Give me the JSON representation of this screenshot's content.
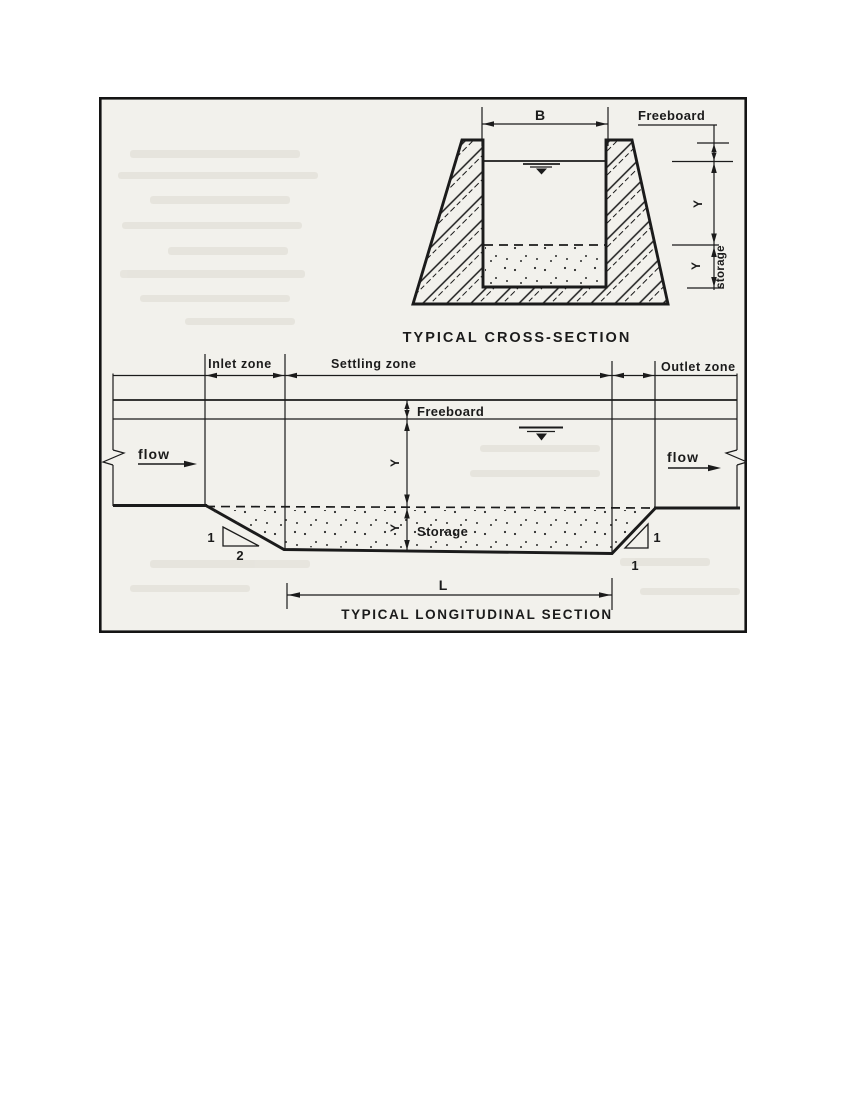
{
  "page": {
    "background": "#ffffff"
  },
  "figure": {
    "paper_color": "#f2f1ec",
    "ink_color": "#1b1b1b",
    "cross_section": {
      "title": "TYPICAL CROSS-SECTION",
      "width_dim": "B",
      "freeboard_label": "Freeboard",
      "depth_label": "Y",
      "storage_depth_label": "Y",
      "storage_label": "storage"
    },
    "longitudinal_section": {
      "title": "TYPICAL LONGITUDINAL SECTION",
      "inlet_zone_label": "Inlet zone",
      "settling_zone_label": "Settling zone",
      "outlet_zone_label": "Outlet zone",
      "freeboard_label": "Freeboard",
      "storage_label": "Storage",
      "flow_left_label": "flow",
      "flow_right_label": "flow",
      "depth_label": "Y",
      "storage_depth_label": "Y",
      "length_dim": "L",
      "inlet_slope_vertical": "1",
      "inlet_slope_horizontal": "2",
      "outlet_slope_vertical": "1",
      "outlet_slope_horizontal": "1"
    }
  }
}
